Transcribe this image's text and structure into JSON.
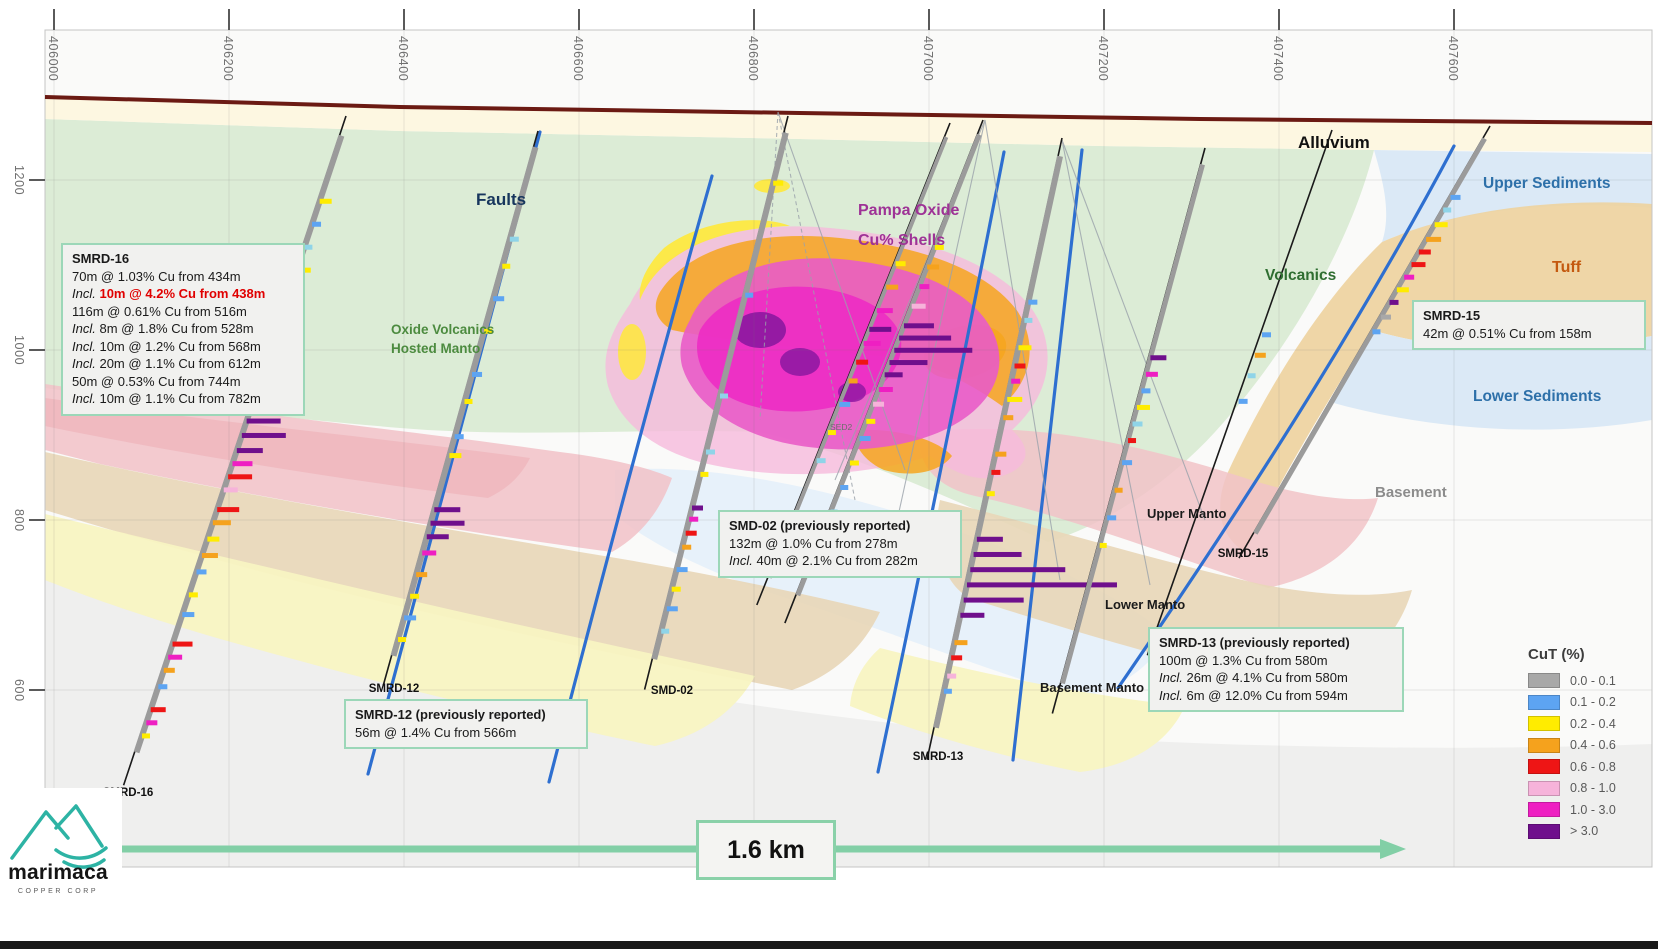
{
  "axes": {
    "top_labels": [
      "406000",
      "406200",
      "406400",
      "406600",
      "406800",
      "407000",
      "407200",
      "407400",
      "407600"
    ],
    "left_labels": [
      "1200",
      "1000",
      "800",
      "600"
    ]
  },
  "unit_labels": [
    {
      "id": "faults",
      "text": "Faults",
      "color": "#17365d"
    },
    {
      "id": "oxide-manto",
      "lines": [
        "Oxide Volcanics",
        "Hosted Manto"
      ],
      "color": "#4c8b3f"
    },
    {
      "id": "pampa",
      "lines": [
        "Pampa Oxide",
        "Cu% Shells"
      ],
      "color": "#9e3296"
    },
    {
      "id": "alluvium",
      "text": "Alluvium",
      "color": "#111111"
    },
    {
      "id": "upper-sediments",
      "text": "Upper Sediments",
      "color": "#2d70a9"
    },
    {
      "id": "tuff",
      "text": "Tuff",
      "color": "#c4590f"
    },
    {
      "id": "volcanics",
      "text": "Volcanics",
      "color": "#2f6e31"
    },
    {
      "id": "lower-sediments",
      "text": "Lower Sediments",
      "color": "#2d70a9"
    },
    {
      "id": "basement",
      "text": "Basement",
      "color": "#8c8c8c"
    },
    {
      "id": "upper-manto",
      "text": "Upper Manto",
      "color": "#1a1a1a"
    },
    {
      "id": "lower-manto",
      "text": "Lower Manto",
      "color": "#1a1a1a"
    },
    {
      "id": "basement-manto",
      "text": "Basement Manto",
      "color": "#1a1a1a"
    },
    {
      "id": "sed2",
      "text": "SED2",
      "color": "#6d6d6d"
    }
  ],
  "boxes": [
    {
      "id": "smrd16",
      "title": "SMRD-16",
      "lines": [
        {
          "text": "70m @ 1.03% Cu from 434m"
        },
        {
          "prefix": "Incl.",
          "text": "10m @ 4.2% Cu from 438m",
          "highlight": true
        },
        {
          "text": "116m @ 0.61% Cu from 516m"
        },
        {
          "prefix": "Incl.",
          "text": "8m @ 1.8% Cu from 528m"
        },
        {
          "prefix": "Incl.",
          "text": "10m @ 1.2% Cu from 568m"
        },
        {
          "prefix": "Incl.",
          "text": "20m @ 1.1% Cu from 612m"
        },
        {
          "text": "50m @ 0.53% Cu from 744m"
        },
        {
          "prefix": "Incl.",
          "text": "10m @ 1.1% Cu from 782m"
        }
      ]
    },
    {
      "id": "smrd12",
      "title": "SMRD-12 (previously reported)",
      "lines": [
        {
          "text": "56m @ 1.4% Cu from 566m"
        }
      ]
    },
    {
      "id": "smd02",
      "title": "SMD-02 (previously reported)",
      "lines": [
        {
          "text": "132m @ 1.0% Cu from 278m"
        },
        {
          "prefix": "Incl.",
          "text": "40m @ 2.1% Cu from 282m"
        }
      ]
    },
    {
      "id": "smrd13",
      "title": "SMRD-13 (previously reported)",
      "lines": [
        {
          "text": "100m @ 1.3% Cu from 580m"
        },
        {
          "prefix": "Incl.",
          "text": "26m @ 4.1% Cu from 580m"
        },
        {
          "prefix": "Incl.",
          "text": "6m @ 12.0% Cu from 594m"
        }
      ]
    },
    {
      "id": "smrd15",
      "title": "SMRD-15",
      "lines": [
        {
          "text": "42m @ 0.51% Cu from 158m"
        }
      ]
    }
  ],
  "legend": {
    "title": "CuT (%)",
    "items": [
      {
        "label": "0.0 - 0.1",
        "color": "#a8a8a8"
      },
      {
        "label": "0.1 - 0.2",
        "color": "#5da4f2"
      },
      {
        "label": "0.2 - 0.4",
        "color": "#ffec00"
      },
      {
        "label": "0.4 - 0.6",
        "color": "#f5a21d"
      },
      {
        "label": "0.6 - 0.8",
        "color": "#ee1515"
      },
      {
        "label": "0.8 - 1.0",
        "color": "#f6b3da"
      },
      {
        "label": "1.0 - 3.0",
        "color": "#ee1fc2"
      },
      {
        "label": "> 3.0",
        "color": "#6f0f8c"
      }
    ]
  },
  "palette": {
    "g": "#a8a8a8",
    "b": "#5da4f2",
    "c": "#8fd4e8",
    "y": "#ffec00",
    "o": "#f5a21d",
    "r": "#ee1515",
    "p": "#f6b3da",
    "m": "#ee1fc2",
    "u": "#6f0f8c"
  },
  "scale_bar": {
    "label": "1.6 km",
    "color": "#82cfa6"
  },
  "logo": {
    "name": "marimaca",
    "subtext": "COPPER CORP",
    "color": "#2db3a4"
  },
  "terrain_color": "#6b1a13",
  "holes": [
    {
      "name": "SMRD-16",
      "label": "SMRD-16",
      "label_pos": [
        128,
        796
      ],
      "collar": [
        346,
        116
      ],
      "toe": [
        128,
        772
      ],
      "gray": 6,
      "bars": [
        [
          0.13,
          12,
          "y"
        ],
        [
          0.165,
          9,
          "b"
        ],
        [
          0.2,
          8,
          "c"
        ],
        [
          0.235,
          14,
          "y"
        ],
        [
          0.27,
          10,
          "b"
        ],
        [
          0.3,
          18,
          "o"
        ],
        [
          0.32,
          22,
          "o"
        ],
        [
          0.34,
          16,
          "r"
        ],
        [
          0.36,
          12,
          "m"
        ],
        [
          0.38,
          10,
          "y"
        ],
        [
          0.4,
          9,
          "b"
        ],
        [
          0.465,
          34,
          "u"
        ],
        [
          0.487,
          44,
          "u"
        ],
        [
          0.51,
          26,
          "u"
        ],
        [
          0.53,
          20,
          "m"
        ],
        [
          0.55,
          24,
          "r"
        ],
        [
          0.57,
          14,
          "p"
        ],
        [
          0.6,
          22,
          "r"
        ],
        [
          0.62,
          18,
          "o"
        ],
        [
          0.645,
          12,
          "y"
        ],
        [
          0.67,
          16,
          "o"
        ],
        [
          0.695,
          10,
          "b"
        ],
        [
          0.73,
          9,
          "y"
        ],
        [
          0.76,
          12,
          "b"
        ],
        [
          0.805,
          20,
          "r"
        ],
        [
          0.825,
          14,
          "m"
        ],
        [
          0.845,
          11,
          "o"
        ],
        [
          0.87,
          9,
          "b"
        ],
        [
          0.905,
          15,
          "r"
        ],
        [
          0.925,
          11,
          "m"
        ],
        [
          0.945,
          8,
          "y"
        ]
      ]
    },
    {
      "name": "SMRD-12",
      "label": "SMRD-12",
      "label_pos": [
        394,
        692
      ],
      "collar": [
        538,
        131
      ],
      "toe": [
        387,
        672
      ],
      "gray": 6,
      "bars": [
        [
          0.2,
          9,
          "c"
        ],
        [
          0.25,
          8,
          "y"
        ],
        [
          0.31,
          11,
          "b"
        ],
        [
          0.37,
          8,
          "y"
        ],
        [
          0.45,
          10,
          "b"
        ],
        [
          0.5,
          8,
          "y"
        ],
        [
          0.565,
          9,
          "b"
        ],
        [
          0.6,
          12,
          "y"
        ],
        [
          0.7,
          26,
          "u"
        ],
        [
          0.725,
          34,
          "u"
        ],
        [
          0.75,
          22,
          "u"
        ],
        [
          0.78,
          14,
          "m"
        ],
        [
          0.82,
          11,
          "o"
        ],
        [
          0.86,
          9,
          "y"
        ],
        [
          0.9,
          12,
          "b"
        ],
        [
          0.94,
          8,
          "y"
        ]
      ]
    },
    {
      "name": "SMD-02",
      "label": "SMD-02",
      "label_pos": [
        672,
        694
      ],
      "collar": [
        788,
        116
      ],
      "toe": [
        648,
        676
      ],
      "gray": 6,
      "bars": [
        [
          0.12,
          10,
          "y"
        ],
        [
          0.32,
          8,
          "b"
        ],
        [
          0.5,
          8,
          "c"
        ],
        [
          0.6,
          9,
          "c"
        ],
        [
          0.64,
          8,
          "y"
        ],
        [
          0.7,
          11,
          "u"
        ],
        [
          0.72,
          9,
          "m"
        ],
        [
          0.745,
          11,
          "r"
        ],
        [
          0.77,
          9,
          "o"
        ],
        [
          0.81,
          11,
          "b"
        ],
        [
          0.845,
          9,
          "y"
        ],
        [
          0.88,
          11,
          "b"
        ],
        [
          0.92,
          8,
          "c"
        ]
      ]
    },
    {
      "name": "SED2-hole",
      "collar": [
        983,
        120
      ],
      "toe": [
        790,
        610
      ],
      "gray": 5,
      "bars": [
        [
          0.26,
          9,
          "y"
        ],
        [
          0.3,
          12,
          "o"
        ],
        [
          0.34,
          10,
          "m"
        ],
        [
          0.38,
          14,
          "p"
        ],
        [
          0.42,
          30,
          "u"
        ],
        [
          0.445,
          52,
          "u"
        ],
        [
          0.47,
          78,
          "u"
        ],
        [
          0.495,
          38,
          "u"
        ],
        [
          0.52,
          18,
          "u"
        ],
        [
          0.55,
          14,
          "m"
        ],
        [
          0.58,
          11,
          "p"
        ],
        [
          0.615,
          9,
          "y"
        ],
        [
          0.65,
          11,
          "b"
        ],
        [
          0.7,
          9,
          "y"
        ],
        [
          0.75,
          8,
          "b"
        ],
        [
          0.8,
          7,
          "c"
        ]
      ]
    },
    {
      "name": "mid-hole",
      "collar": [
        950,
        123
      ],
      "toe": [
        762,
        592
      ],
      "gray": 4,
      "bars": [
        [
          0.3,
          10,
          "y"
        ],
        [
          0.35,
          12,
          "o"
        ],
        [
          0.4,
          16,
          "m"
        ],
        [
          0.44,
          22,
          "u"
        ],
        [
          0.47,
          17,
          "m"
        ],
        [
          0.51,
          12,
          "r"
        ],
        [
          0.55,
          9,
          "o"
        ],
        [
          0.6,
          11,
          "b"
        ],
        [
          0.66,
          8,
          "y"
        ],
        [
          0.72,
          9,
          "c"
        ]
      ]
    },
    {
      "name": "SMRD-13",
      "label": "SMRD-13",
      "label_pos": [
        938,
        760
      ],
      "collar": [
        1062,
        138
      ],
      "toe": [
        930,
        746
      ],
      "gray": 6,
      "bars": [
        [
          0.27,
          9,
          "b"
        ],
        [
          0.3,
          8,
          "c"
        ],
        [
          0.345,
          13,
          "y"
        ],
        [
          0.375,
          11,
          "r"
        ],
        [
          0.4,
          9,
          "m"
        ],
        [
          0.43,
          15,
          "y"
        ],
        [
          0.46,
          10,
          "o"
        ],
        [
          0.52,
          11,
          "o"
        ],
        [
          0.55,
          9,
          "r"
        ],
        [
          0.585,
          8,
          "y"
        ],
        [
          0.66,
          26,
          "u"
        ],
        [
          0.685,
          48,
          "u"
        ],
        [
          0.71,
          95,
          "u"
        ],
        [
          0.735,
          150,
          "u"
        ],
        [
          0.76,
          60,
          "u"
        ],
        [
          0.785,
          24,
          "u"
        ],
        [
          0.83,
          13,
          "o"
        ],
        [
          0.855,
          11,
          "r"
        ],
        [
          0.885,
          9,
          "p"
        ],
        [
          0.91,
          8,
          "b"
        ]
      ]
    },
    {
      "name": "hole-14",
      "collar": [
        1205,
        148
      ],
      "toe": [
        1056,
        700
      ],
      "gray": 5,
      "bars": [
        [
          0.38,
          16,
          "u"
        ],
        [
          0.41,
          12,
          "m"
        ],
        [
          0.44,
          9,
          "b"
        ],
        [
          0.47,
          13,
          "y"
        ],
        [
          0.5,
          10,
          "c"
        ],
        [
          0.53,
          8,
          "r"
        ],
        [
          0.57,
          10,
          "b"
        ],
        [
          0.62,
          8,
          "o"
        ],
        [
          0.67,
          9,
          "b"
        ],
        [
          0.72,
          7,
          "y"
        ]
      ]
    },
    {
      "name": "SMRD-15",
      "label": "SMRD-15",
      "label_pos": [
        1243,
        557
      ],
      "collar": [
        1490,
        126
      ],
      "toe": [
        1246,
        546
      ],
      "gray": 5,
      "bars": [
        [
          0.17,
          10,
          "b"
        ],
        [
          0.2,
          8,
          "c"
        ],
        [
          0.235,
          13,
          "y"
        ],
        [
          0.27,
          15,
          "o"
        ],
        [
          0.3,
          12,
          "r"
        ],
        [
          0.33,
          14,
          "r"
        ],
        [
          0.36,
          10,
          "m"
        ],
        [
          0.39,
          12,
          "y"
        ],
        [
          0.42,
          9,
          "u"
        ],
        [
          0.455,
          10,
          "g"
        ],
        [
          0.49,
          8,
          "b"
        ]
      ]
    },
    {
      "name": "thin-hole",
      "collar": [
        1332,
        130
      ],
      "toe": [
        1152,
        642
      ],
      "gray": 0,
      "bars": [
        [
          0.4,
          9,
          "b"
        ],
        [
          0.44,
          11,
          "o"
        ],
        [
          0.48,
          8,
          "c"
        ],
        [
          0.53,
          9,
          "b"
        ]
      ]
    }
  ]
}
